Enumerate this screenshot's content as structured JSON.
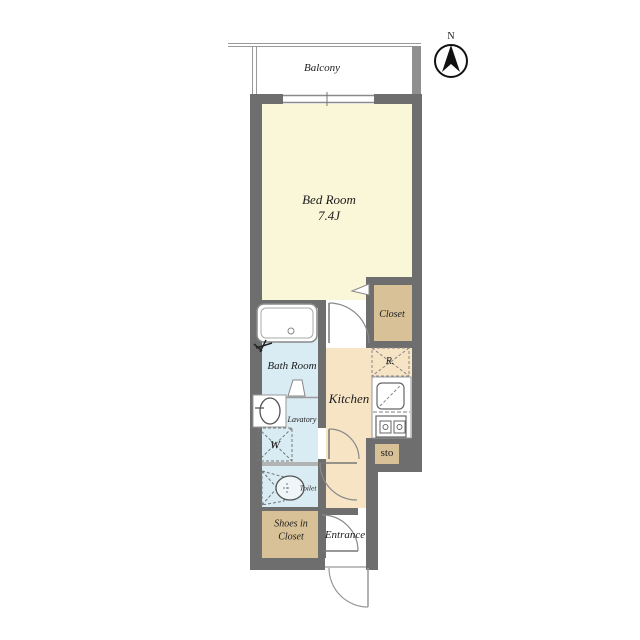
{
  "plan": {
    "type": "apartment-floor-plan",
    "compass": {
      "label": "N"
    },
    "rooms": {
      "balcony": {
        "label": "Balcony"
      },
      "bedroom": {
        "label": "Bed Room",
        "size": "7.4J"
      },
      "closet": {
        "label": "Closet"
      },
      "bathroom": {
        "label": "Bath Room"
      },
      "kitchen": {
        "label": "Kitchen"
      },
      "lavatory": {
        "label": "Lavatory"
      },
      "washer": {
        "label": "W"
      },
      "refrigerator": {
        "label": "R."
      },
      "storage": {
        "label": "sto"
      },
      "toilet": {
        "label": "Toilet"
      },
      "shoes_closet": {
        "line1": "Shoes in",
        "line2": "Closet"
      },
      "entrance": {
        "label": "Entrance"
      }
    }
  },
  "colors": {
    "wall": "#6e6e6e",
    "wall_light": "#8f8f8f",
    "divider": "#b3b3b3",
    "outline": "#8a8a8a",
    "bedroom": "#faf6d8",
    "tan": "#d8c196",
    "kitchen": "#f6e4c5",
    "bath": "#d9ecf4",
    "text": "#1c1c1c"
  }
}
